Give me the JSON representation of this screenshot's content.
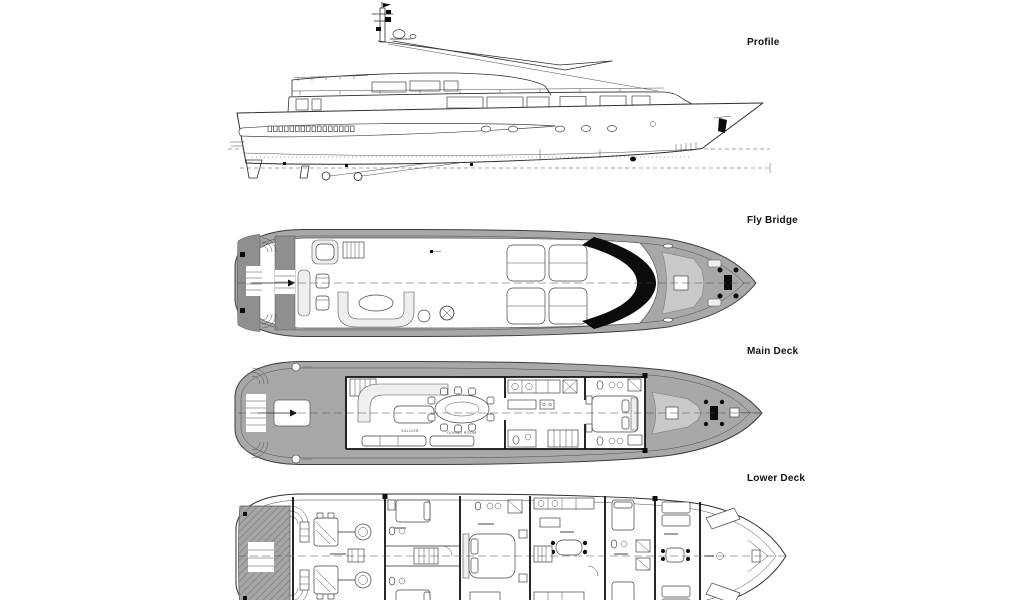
{
  "views": {
    "profile": {
      "label": "Profile"
    },
    "fly_bridge": {
      "label": "Fly Bridge"
    },
    "main_deck": {
      "label": "Main Deck",
      "room_labels": {
        "saloon": "SALOON",
        "dining_room": "DINING ROOM"
      }
    },
    "lower_deck": {
      "label": "Lower Deck"
    }
  },
  "colors": {
    "background": "#ffffff",
    "line": "#2e2e2e",
    "deck_shade": "#a8a8a8",
    "deck_shade_dark": "#8f8f8f",
    "teak_panel": "#c9c9c9",
    "windshield": "#0c0c0c",
    "label_text": "#111111"
  }
}
